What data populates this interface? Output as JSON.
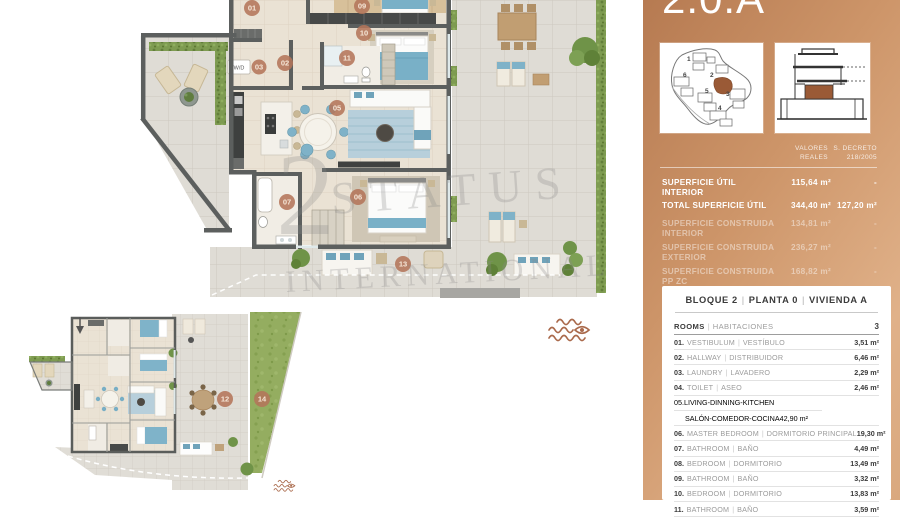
{
  "panel": {
    "title": "2.0.A",
    "surface": {
      "columns": {
        "c1a": "VALORES",
        "c1b": "REALES",
        "c2a": "S. DECRETO",
        "c2b": "218/2005"
      },
      "rows": [
        {
          "label": "SUPERFICIE ÚTIL INTERIOR",
          "real": "115,64 m²",
          "decreto": "-"
        },
        {
          "label": "TOTAL SUPERFICIE ÚTIL",
          "real": "344,40 m²",
          "decreto": "127,20 m²"
        },
        {
          "label": "SUPERFICIE CONSTRUIDA INTERIOR",
          "real": "134,81 m²",
          "decreto": "-"
        },
        {
          "label": "SUPERFICIE CONSTRUIDA EXTERIOR",
          "real": "236,27 m²",
          "decreto": "-"
        },
        {
          "label": "SUPERFICIE CONSTRUIDA PP ZC",
          "real": "168,82 m²",
          "decreto": "-"
        },
        {
          "label": "TOTAL SUPERFICIE CONSTRUIDA",
          "real": "414,71 m²",
          "decreto": "180,39 m²"
        }
      ]
    },
    "card": {
      "separator": "|",
      "header": {
        "block": "BLOQUE 2",
        "planta": "PLANTA 0",
        "vivienda": "VIVIENDA A"
      },
      "rooms_header": {
        "en": "ROOMS",
        "es": "HABITACIONES",
        "count": "3"
      },
      "rooms": [
        {
          "num": "01.",
          "name_en": "VESTIBULUM",
          "name_es": "VESTÍBULO",
          "area": "3,51 m²"
        },
        {
          "num": "02.",
          "name_en": "HALLWAY",
          "name_es": "DISTRIBUIDOR",
          "area": "6,46 m²"
        },
        {
          "num": "03.",
          "name_en": "LAUNDRY",
          "name_es": "LAVADERO",
          "area": "2,29 m²"
        },
        {
          "num": "04.",
          "name_en": "TOILET",
          "name_es": "ASEO",
          "area": "2,46 m²"
        },
        {
          "num": "05.",
          "name_en": "LIVING-DINNING-KITCHEN",
          "name_es": "SALÓN-COMEDOR-COCINA",
          "area": "42,90 m²"
        },
        {
          "num": "06.",
          "name_en": "MASTER BEDROOM",
          "name_es": "DORMITORIO PRINCIPAL",
          "area": "19,30 m²"
        },
        {
          "num": "07.",
          "name_en": "BATHROOM",
          "name_es": "BAÑO",
          "area": "4,49 m²"
        },
        {
          "num": "08.",
          "name_en": "BEDROOM",
          "name_es": "DORMITORIO",
          "area": "13,49 m²"
        },
        {
          "num": "09.",
          "name_en": "BATHROOM",
          "name_es": "BAÑO",
          "area": "3,32 m²"
        },
        {
          "num": "10.",
          "name_en": "BEDROOM",
          "name_es": "DORMITORIO",
          "area": "13,83 m²"
        },
        {
          "num": "11.",
          "name_en": "BATHROOM",
          "name_es": "BAÑO",
          "area": "3,59 m²"
        }
      ]
    },
    "site_plan_numbers": [
      "1",
      "2",
      "3",
      "4",
      "5",
      "6"
    ]
  },
  "plan": {
    "watermark": {
      "digit": "2",
      "line1": "STATUS",
      "line2": "INTERNATIONAL"
    },
    "labels": {
      "r01": "01",
      "r02": "02",
      "r03": "03",
      "r05": "05",
      "r06": "06",
      "r07": "07",
      "r09": "09",
      "r10": "10",
      "r11": "11",
      "r13": "13",
      "wd": "W/D"
    },
    "overview_labels": {
      "r12": "12",
      "r14": "14"
    },
    "icons": {
      "sea_view": "waves-eye",
      "orientation": "down-arrow"
    },
    "colors": {
      "accent": "#b4755a",
      "wall": "#5c5f5e",
      "water_blue": "#79b0c7",
      "grass": "#94ad60"
    }
  }
}
